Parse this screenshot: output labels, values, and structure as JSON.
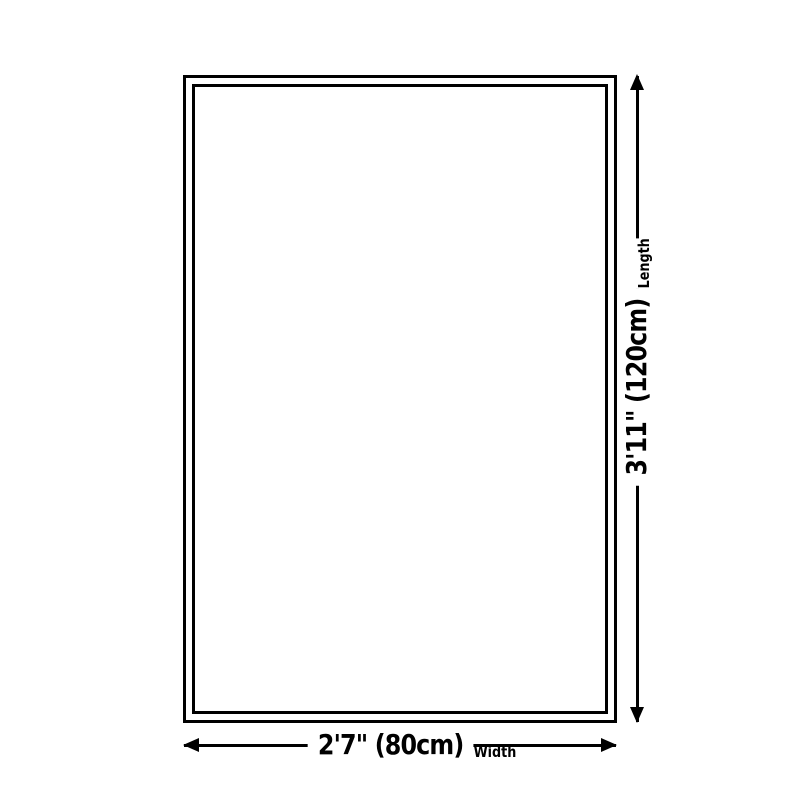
{
  "colors": {
    "background": "#ffffff",
    "line": "#000000",
    "text": "#000000"
  },
  "diagram": {
    "type": "product-size-diagram",
    "dimensions": {
      "length": {
        "value": "3'11\" (120cm)",
        "label": "Length"
      },
      "width": {
        "value": "2'7\" (80cm)",
        "label": "Width"
      }
    }
  }
}
